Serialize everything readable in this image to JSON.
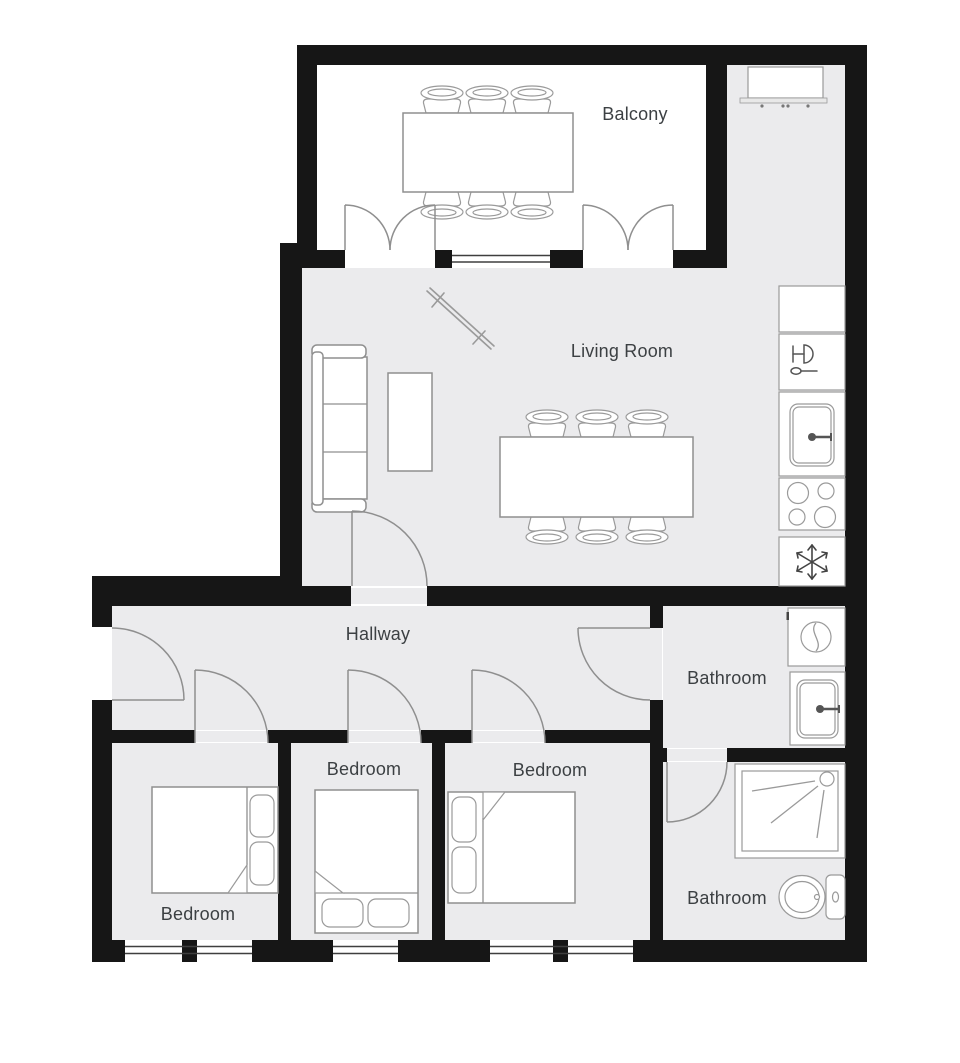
{
  "plan": {
    "rooms": [
      {
        "id": "balcony",
        "label": "Balcony"
      },
      {
        "id": "living-room",
        "label": "Living Room"
      },
      {
        "id": "hallway",
        "label": "Hallway"
      },
      {
        "id": "bathroom-1",
        "label": "Bathroom"
      },
      {
        "id": "bedroom-1",
        "label": "Bedroom"
      },
      {
        "id": "bedroom-2",
        "label": "Bedroom"
      },
      {
        "id": "bedroom-3",
        "label": "Bedroom"
      },
      {
        "id": "bathroom-2",
        "label": "Bathroom"
      }
    ],
    "fixtures": {
      "balcony": [
        "dining-table",
        "dining-chair-icon x6"
      ],
      "living_room": [
        "sofa",
        "coffee-table",
        "wall-decor",
        "dining-table",
        "dining-chair-icon x6",
        "kitchen-cabinet"
      ],
      "kitchen_column": [
        "counter",
        "dishwasher-icon",
        "kitchen-sink-icon",
        "stove-icon",
        "freezer-icon"
      ],
      "bathroom_1": [
        "washing-machine-icon",
        "bathroom-sink-icon"
      ],
      "bathroom_2": [
        "shower-icon",
        "toilet-icon"
      ],
      "bedroom_1": [
        "double-bed"
      ],
      "bedroom_2": [
        "double-bed"
      ],
      "bedroom_3": [
        "double-bed"
      ]
    },
    "colors": {
      "wall": "#161616",
      "floor": "#ebebed",
      "balcony_floor": "#ffffff",
      "furniture_stroke": "#8f8f8f",
      "label_text": "#3c4043",
      "background": "#ffffff"
    }
  }
}
